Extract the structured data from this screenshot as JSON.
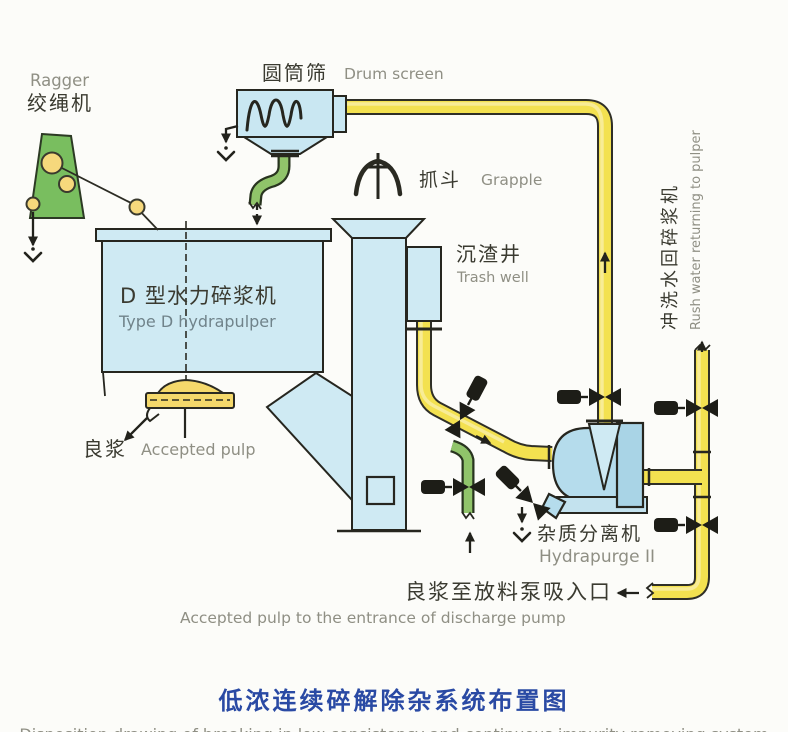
{
  "colors": {
    "background": "#fcfcf9",
    "equipment_blue": "#cfeaf3",
    "pump_blue": "#b5dcec",
    "pipe_yellow": "#f3e150",
    "pipe_green": "#90c46a",
    "ragger_green": "#79be5f",
    "pulley_yellow": "#f6d87c",
    "rotor_yellow": "#f5d96b",
    "title_blue": "#2a4aa4",
    "label_dark": "#3a3a30",
    "label_gray": "#8f8f84",
    "outline_dark": "#26261f"
  },
  "labels": {
    "ragger": {
      "zh": "绞绳机",
      "en": "Ragger"
    },
    "drum_screen": {
      "zh": "圆筒筛",
      "en": "Drum screen"
    },
    "grapple": {
      "zh": "抓斗",
      "en": "Grapple"
    },
    "trash_well": {
      "zh": "沉渣井",
      "en": "Trash well"
    },
    "hydrapulper": {
      "zh": "D 型水力碎浆机",
      "en": "Type D hydrapulper"
    },
    "accepted_pulp": {
      "zh": "良浆",
      "en": "Accepted pulp"
    },
    "hydrapurge": {
      "zh": "杂质分离机",
      "en": "Hydrapurge II"
    },
    "flush_water": {
      "zh": "冲洗水回碎浆机",
      "en": "Rush water returning to pulper"
    },
    "discharge": {
      "zh": "良浆至放料泵吸入口",
      "en": "Accepted pulp to the entrance of discharge pump"
    }
  },
  "title": {
    "zh": "低浓连续碎解除杂系统布置图",
    "en": "Disposition drawing of breaking in low consistency and continuous impurity removing system"
  }
}
